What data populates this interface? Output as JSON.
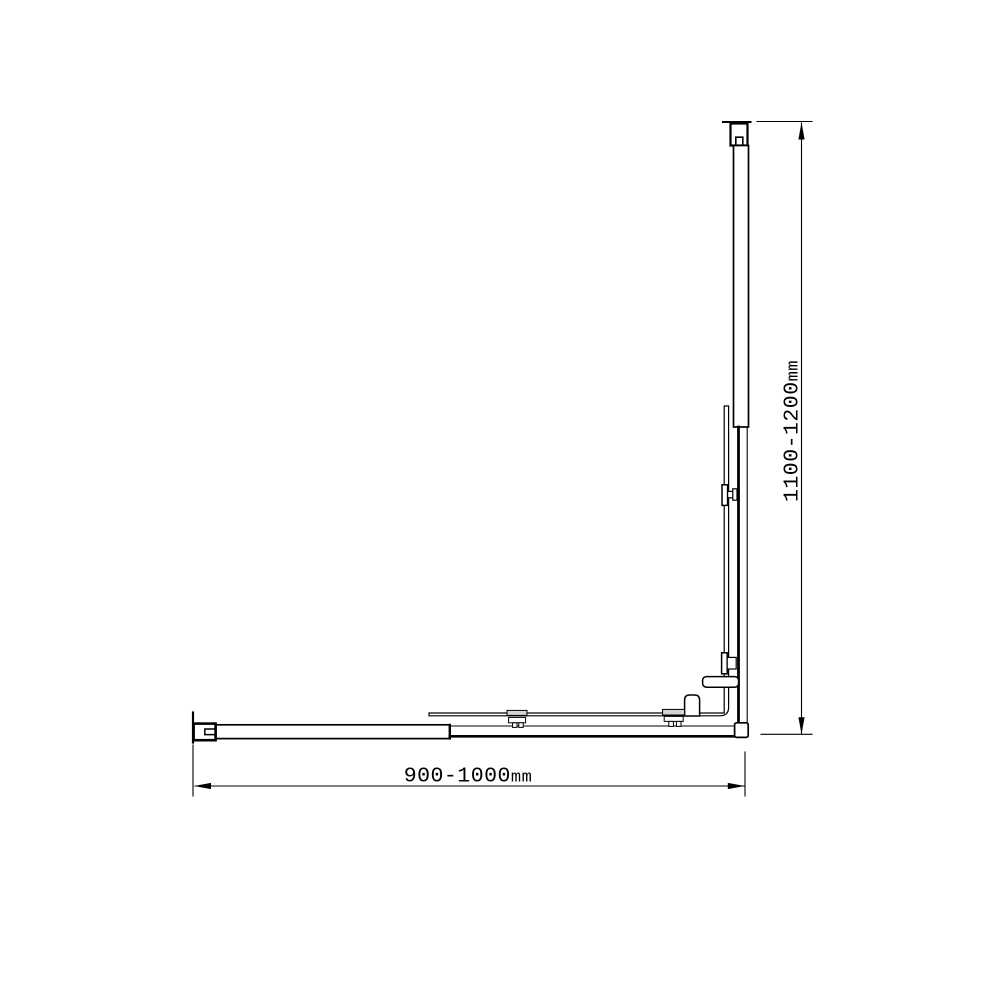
{
  "drawing": {
    "title": "corner-shower-screen-technical-drawing",
    "dimensions": {
      "width": {
        "value": "900-1000",
        "unit": "mm"
      },
      "height": {
        "value": "1100-1200",
        "unit": "mm"
      }
    }
  },
  "colors": {
    "line": "#000000",
    "background": "#ffffff",
    "clamp_pad_fill": "#d4d4d4"
  }
}
